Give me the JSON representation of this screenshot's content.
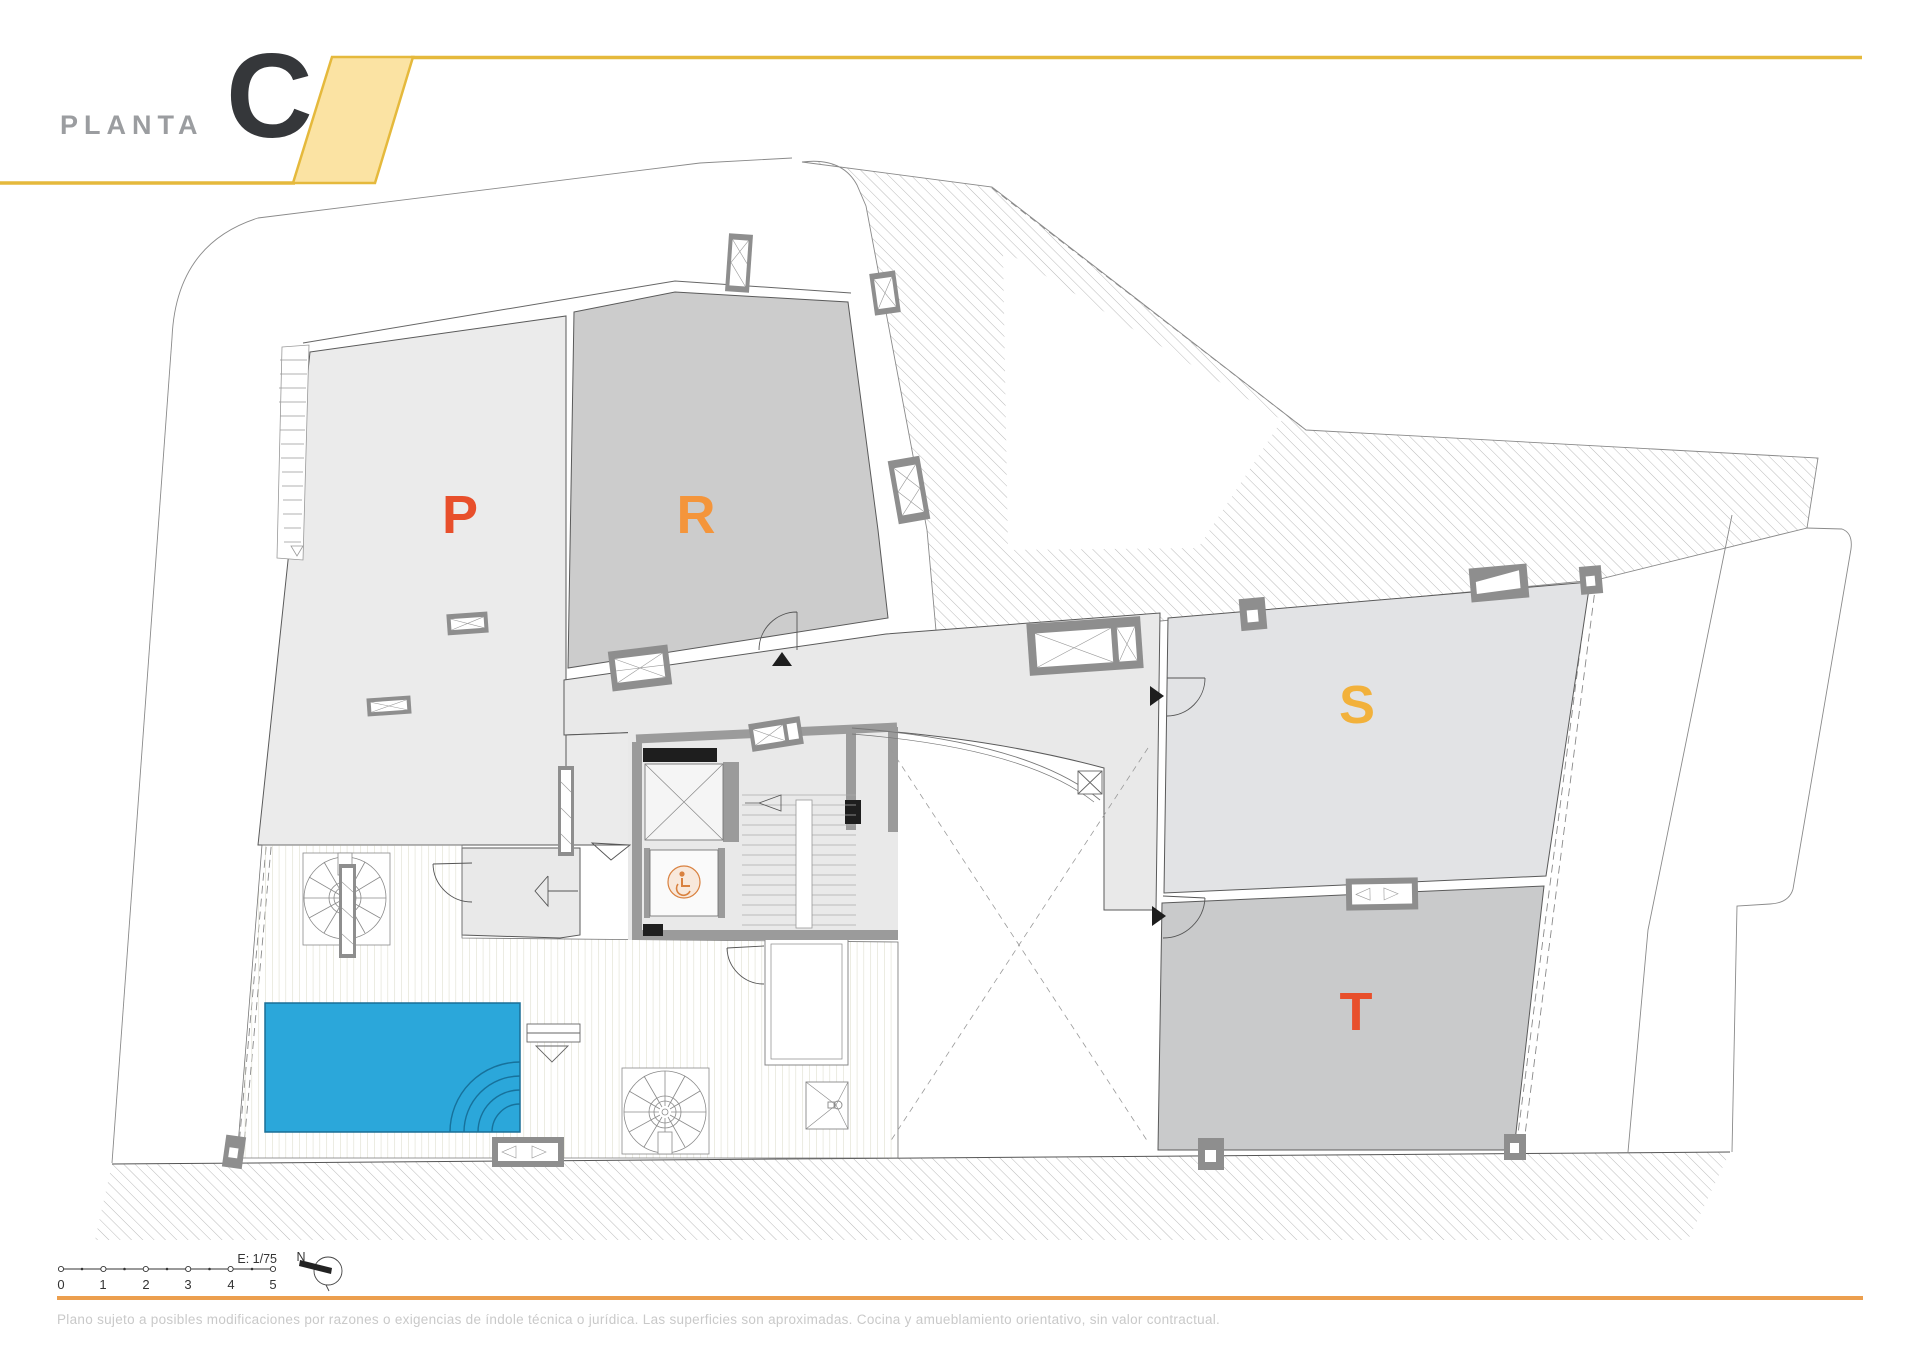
{
  "header": {
    "label": "PLANTA",
    "floor": "C"
  },
  "rooms": {
    "p": {
      "label": "P",
      "color": "#E84F2B"
    },
    "r": {
      "label": "R",
      "color": "#F4953B"
    },
    "s": {
      "label": "S",
      "color": "#F2B13B"
    },
    "t": {
      "label": "T",
      "color": "#E84F2B"
    }
  },
  "scale": {
    "label": "E: 1/75",
    "north": "N",
    "ticks": [
      "0",
      "1",
      "2",
      "3",
      "4",
      "5"
    ]
  },
  "footer": {
    "disclaimer": "Plano sujeto a posibles modificaciones por razones o exigencias de índole técnica o jurídica. Las superficies son aproximadas. Cocina y amueblamiento orientativo, sin valor contractual."
  },
  "colors": {
    "accent_yellow": "#E5B93C",
    "accent_yellow_fill": "#FBE3A3",
    "accent_orange": "#EC9F4E",
    "pool": "#2BA7DA",
    "wheelchair": "#D9813F"
  }
}
